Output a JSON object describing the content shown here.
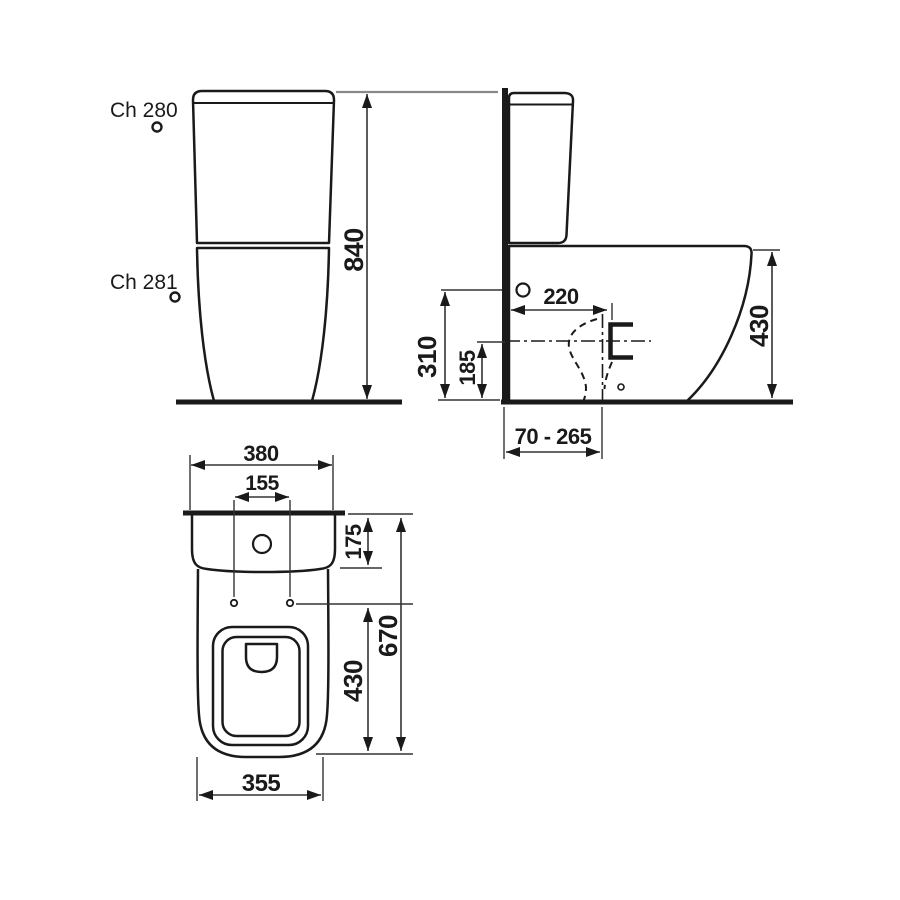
{
  "drawing": {
    "front_view": {
      "label_cistern": "Ch 280",
      "label_bowl": "Ch 281",
      "dim_total_height": "840"
    },
    "side_view": {
      "dim_outlet_depth": "220",
      "dim_inlet_height": "310",
      "dim_outlet_axis_height": "185",
      "dim_rim_height": "430",
      "dim_outlet_range": "70 - 265"
    },
    "plan_view": {
      "dim_overall_width": "380",
      "dim_seat_hole_spacing": "155",
      "dim_cistern_depth": "175",
      "dim_total_depth": "670",
      "dim_bowl_depth": "430",
      "dim_bowl_front_width": "355"
    },
    "colors": {
      "line": "#1a1a1a",
      "dim_line": "#333333",
      "extension_gray": "#8a8a8a",
      "background": "#ffffff"
    }
  }
}
